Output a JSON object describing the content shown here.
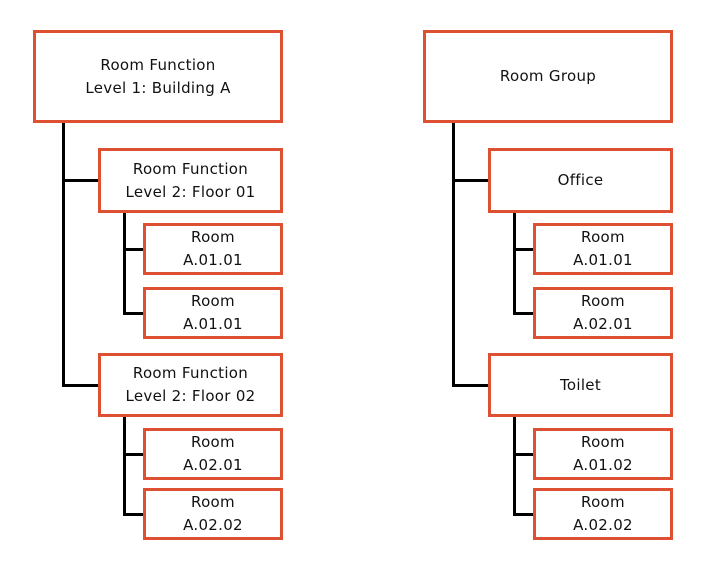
{
  "colors": {
    "node_border": "#de5032",
    "node_fill": "#ffffff",
    "connector": "#000000",
    "text": "#111111"
  },
  "trees": [
    {
      "id": "room-function-hierarchy",
      "root": {
        "line1": "Room Function",
        "line2": "Level 1: Building A"
      },
      "branches": [
        {
          "label": {
            "line1": "Room Function",
            "line2": "Level 2: Floor 01"
          },
          "leaves": [
            {
              "line1": "Room",
              "line2": "A.01.01"
            },
            {
              "line1": "Room",
              "line2": "A.01.01"
            }
          ]
        },
        {
          "label": {
            "line1": "Room Function",
            "line2": "Level 2: Floor 02"
          },
          "leaves": [
            {
              "line1": "Room",
              "line2": "A.02.01"
            },
            {
              "line1": "Room",
              "line2": "A.02.02"
            }
          ]
        }
      ]
    },
    {
      "id": "room-group-hierarchy",
      "root": {
        "line1": "Room Group"
      },
      "branches": [
        {
          "label": {
            "line1": "Office"
          },
          "leaves": [
            {
              "line1": "Room",
              "line2": "A.01.01"
            },
            {
              "line1": "Room",
              "line2": "A.02.01"
            }
          ]
        },
        {
          "label": {
            "line1": "Toilet"
          },
          "leaves": [
            {
              "line1": "Room",
              "line2": "A.01.02"
            },
            {
              "line1": "Room",
              "line2": "A.02.02"
            }
          ]
        }
      ]
    }
  ]
}
